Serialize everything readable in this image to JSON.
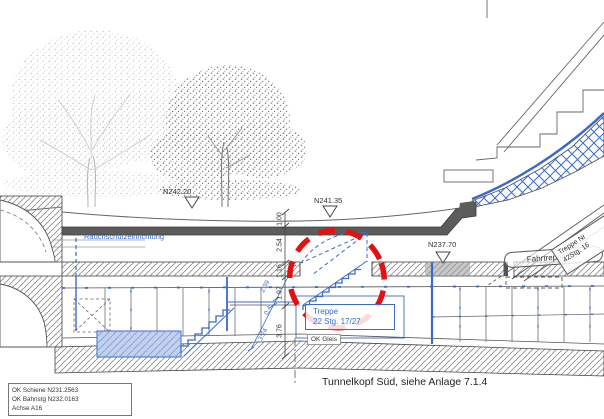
{
  "drawing": {
    "section_title": "Tunnelkopf Süd, siehe Anlage 7.1.4",
    "elevation_markers": [
      {
        "label": "N242.20"
      },
      {
        "label": "N241.35"
      },
      {
        "label": "N237.70"
      }
    ],
    "labels": {
      "smoke_protection": "Rauchschutzeinrichtung",
      "center_stair_line1": "Treppe",
      "center_stair_line2": "22 Stg. 17/27",
      "ok_gleis": "OK Gleis",
      "right_stair_line1": "Treppe Nr",
      "right_stair_line2": "42Stg. 16",
      "escalator": "Fahrtreppe 30°"
    },
    "dimensions": {
      "vertical_chain": [
        "1.00",
        "2.54",
        "1.16",
        "1.97",
        "3.76"
      ],
      "diagonal_chain": [
        "2.39",
        "0.4",
        "3.24"
      ]
    },
    "info_box": [
      "OK Schiene N231.2563",
      "OK Bahnstg N232.0163",
      "Achse A16"
    ],
    "colors": {
      "blue": "#3a6bc6",
      "light_blue": "#c3d1ef",
      "red": "#e01212",
      "line": "#4d4d4d"
    }
  }
}
